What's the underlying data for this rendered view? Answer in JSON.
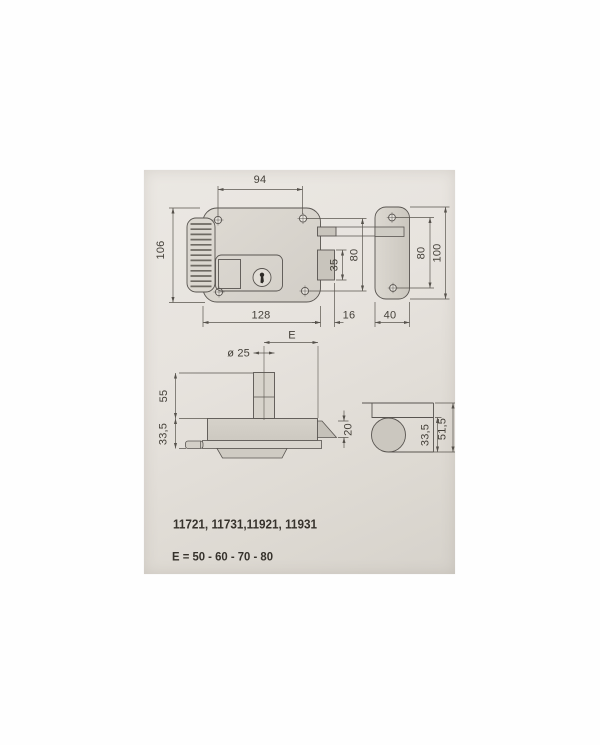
{
  "labels": {
    "codes": "11721, 11731,11921, 11931",
    "backset_options": "E = 50 - 60 - 70 - 80"
  },
  "dims": {
    "top": {
      "hole_span": "94",
      "height": "106",
      "width": "128",
      "throw": "16",
      "bolt_h": "35",
      "rows": "80"
    },
    "strike": {
      "holes": "80",
      "height": "100",
      "width": "40"
    },
    "section": {
      "cyl_dia": "ø 25",
      "backset": "E",
      "cyl_h": "55",
      "depth": "33,5",
      "bolt": "20"
    },
    "end": {
      "depth": "33,5",
      "total": "51,5"
    }
  },
  "colors": {
    "paper": "#e7e3de",
    "paper_dark": "#d6d2cb",
    "line": "#585450",
    "fill_body": "#dbd7d0",
    "fill_bolt": "#c8c4bc",
    "text": "#36322c"
  }
}
